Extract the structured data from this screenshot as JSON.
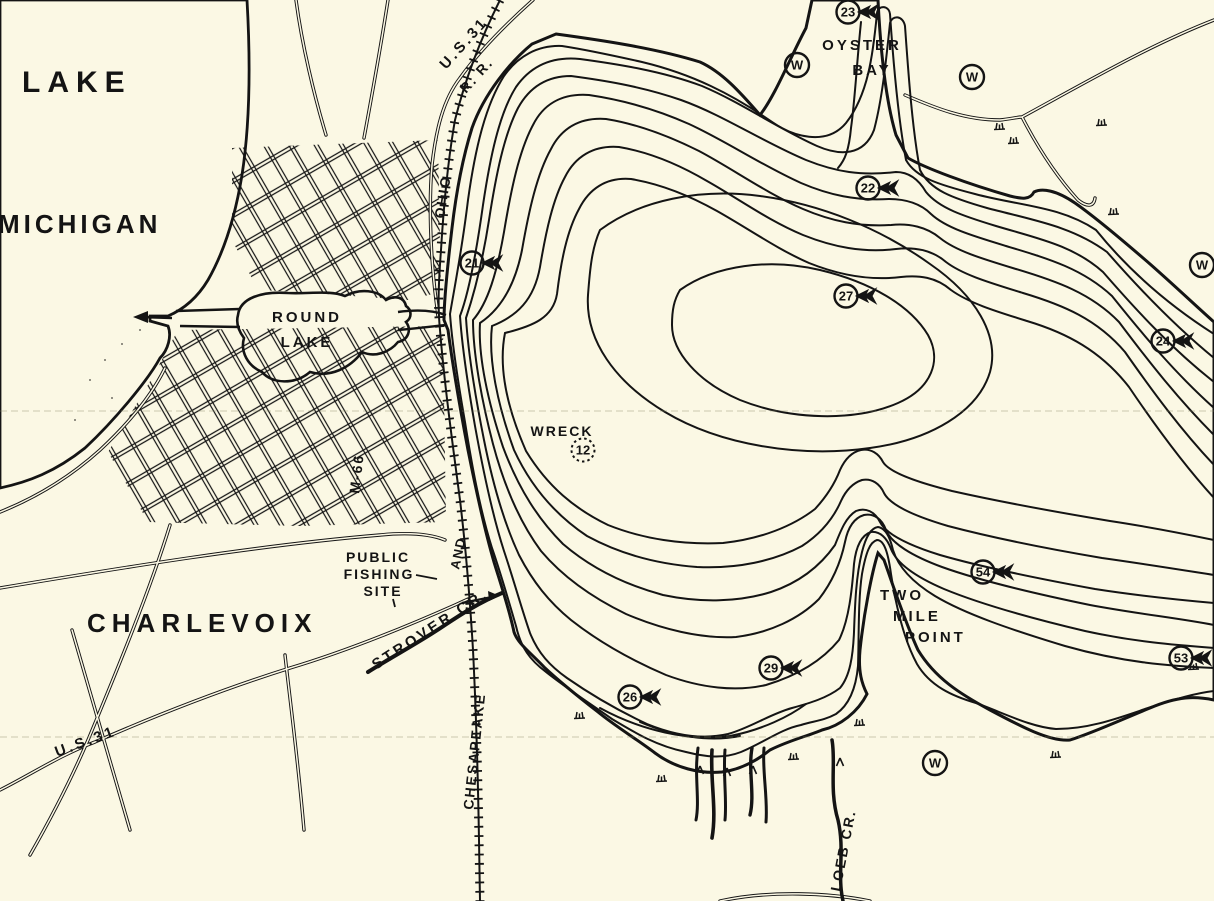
{
  "colors": {
    "water": "#a9b5e9",
    "land": "#fbf8e4",
    "ink": "#141414"
  },
  "labels": {
    "lake_michigan_line1": "LAKE",
    "lake_michigan_line2": "MICHIGAN",
    "round_lake_line1": "ROUND",
    "round_lake_line2": "LAKE",
    "city": "CHARLEVOIX",
    "oyster_bay_line1": "OYSTER",
    "oyster_bay_line2": "BAY",
    "wreck": "WRECK",
    "wreck_depth": "12",
    "two_mile_line1": "TWO",
    "two_mile_line2": "MILE",
    "two_mile_line3": "POINT",
    "fishing_line1": "PUBLIC",
    "fishing_line2": "FISHING",
    "fishing_line3": "SITE",
    "strover_creek": "STROVER CR.",
    "loeb_creek": "LOEB CR.",
    "rr_chesapeake": "CHESAPEAKE",
    "rr_and": "AND",
    "rr_ohio": "OHIO",
    "rr_initials": "R. R.",
    "us31_top": "U.S.31",
    "us31_bottom": "U.S.31",
    "m66": "M-66",
    "well_symbol": "W"
  },
  "fish_markers": [
    {
      "value": "23"
    },
    {
      "value": "22"
    },
    {
      "value": "21"
    },
    {
      "value": "27"
    },
    {
      "value": "24"
    },
    {
      "value": "54"
    },
    {
      "value": "53"
    },
    {
      "value": "29"
    },
    {
      "value": "26"
    }
  ]
}
